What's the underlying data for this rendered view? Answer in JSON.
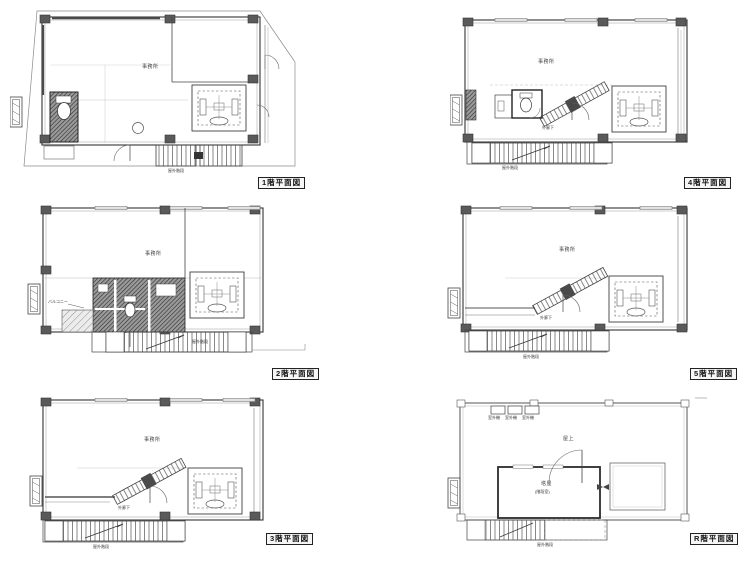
{
  "document": {
    "kind": "architectural floor plan sheet",
    "colors": {
      "paper": "#ffffff",
      "ink": "#3c3c3c",
      "hatch_dark": "#9a9a9a",
      "column": "#5a5a5a"
    }
  },
  "plans": [
    {
      "id": "1f",
      "caption": "1階平面図",
      "labels": {
        "room": "事務所",
        "stair": "屋外階段"
      }
    },
    {
      "id": "2f",
      "caption": "2階平面図",
      "labels": {
        "room": "事務所",
        "balcony": "バルコニー",
        "stair": "屋外階段"
      }
    },
    {
      "id": "3f",
      "caption": "3階平面図",
      "labels": {
        "room": "事務所",
        "corridor": "外廊下",
        "stair": "屋外階段"
      }
    },
    {
      "id": "4f",
      "caption": "4階平面図",
      "labels": {
        "room": "事務所",
        "corridor": "外廊下",
        "stair": "屋外階段"
      }
    },
    {
      "id": "5f",
      "caption": "5階平面図",
      "labels": {
        "room": "事務所",
        "corridor": "外廊下",
        "stair": "屋外階段"
      }
    },
    {
      "id": "rf",
      "caption": "R階平面図",
      "labels": {
        "roof": "屋上",
        "penthouse": "塔屋",
        "penthouse_sub": "(階段室)",
        "ac_unit": "室外機",
        "stair": "屋外階段"
      }
    }
  ]
}
